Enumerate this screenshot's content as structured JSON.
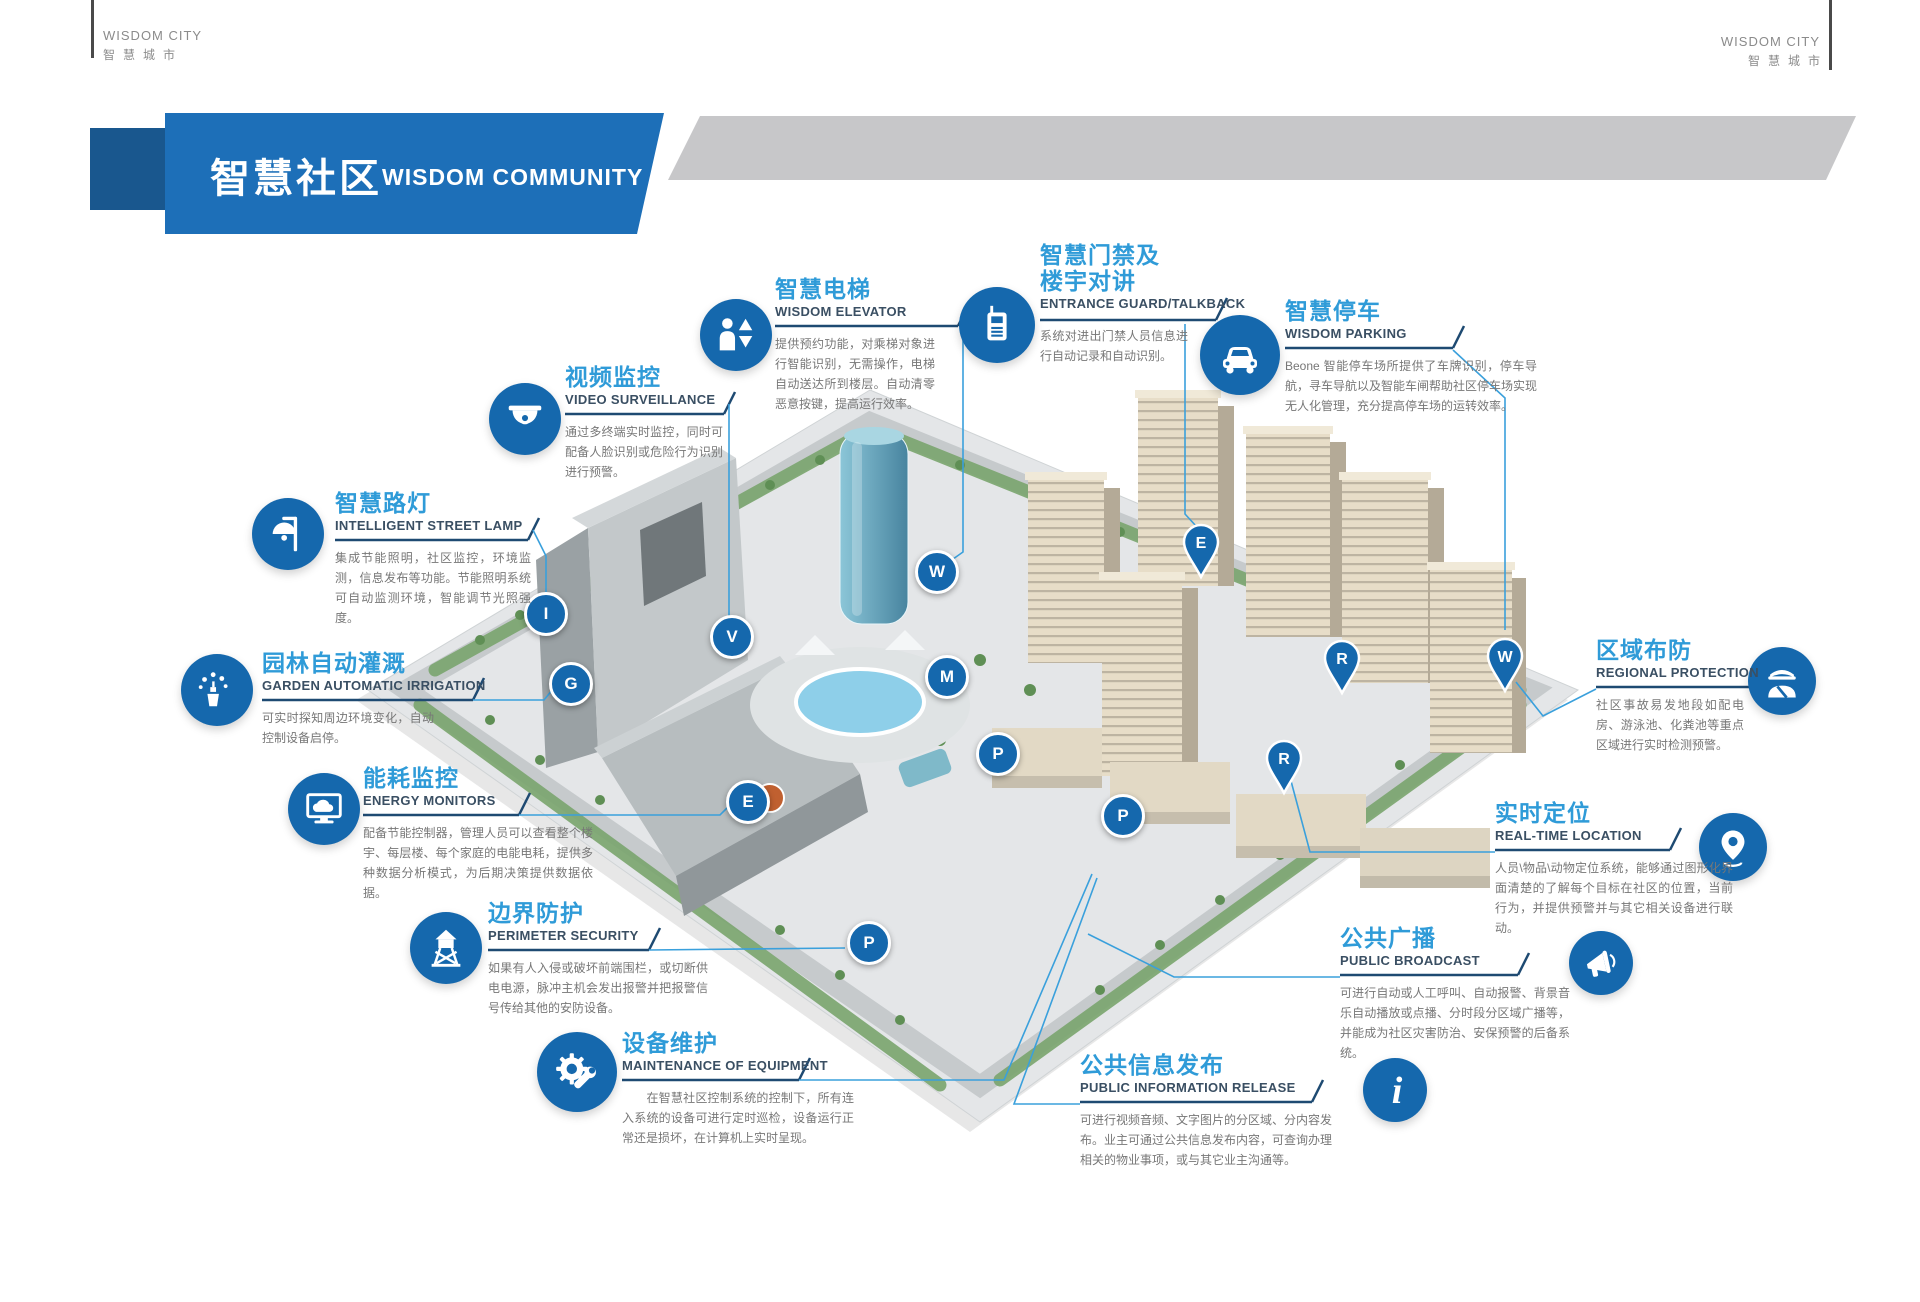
{
  "brand": {
    "en": "WISDOM CITY",
    "cn": "智慧城市"
  },
  "banner": {
    "title_cn": "智慧社区",
    "title_en": "WISDOM COMMUNITY"
  },
  "colors": {
    "banner_blue": "#1d6fb8",
    "banner_dark_blue": "#19578e",
    "gray_band": "#c7c7c9",
    "icon_circle_blue": "#1568ad",
    "title_blue": "#2f9bd8",
    "subtitle_navy": "#3a4f63",
    "underline_navy": "#1e4a72",
    "connector_blue": "#3aa0dc",
    "body_gray": "#777777"
  },
  "callouts": [
    {
      "id": "wisdom-elevator",
      "title_cn": "智慧电梯",
      "title_en": "WISDOM ELEVATOR",
      "icon": "elevator-icon",
      "body": "提供预约功能，对乘梯对象进行智能识别，无需操作，电梯自动送达所到楼层。自动清零恶意按键，提高运行效率。"
    },
    {
      "id": "video-surveillance",
      "title_cn": "视频监控",
      "title_en": "VIDEO SURVEILLANCE",
      "icon": "dome-camera-icon",
      "body": "通过多终端实时监控，同时可配备人脸识别或危险行为识别进行预警。"
    },
    {
      "id": "street-lamp",
      "title_cn": "智慧路灯",
      "title_en": "INTELLIGENT STREET LAMP",
      "icon": "street-lamp-icon",
      "body": "集成节能照明，社区监控，环境监测，信息发布等功能。节能照明系统可自动监测环境，智能调节光照强度。"
    },
    {
      "id": "garden-irrigation",
      "title_cn": "园林自动灌溉",
      "title_en": "GARDEN AUTOMATIC IRRIGATION",
      "icon": "sprinkler-icon",
      "body": "可实时探知周边环境变化，自动控制设备启停。"
    },
    {
      "id": "energy-monitors",
      "title_cn": "能耗监控",
      "title_en": "ENERGY MONITORS",
      "icon": "monitor-cloud-icon",
      "body": "配备节能控制器，管理人员可以查看整个楼宇、每层楼、每个家庭的电能电耗，提供多种数据分析模式，为后期决策提供数据依据。"
    },
    {
      "id": "perimeter-security",
      "title_cn": "边界防护",
      "title_en": "PERIMETER SECURITY",
      "icon": "watchtower-icon",
      "body": "如果有人入侵或破坏前端围栏，或切断供电电源，脉冲主机会发出报警并把报警信号传给其他的安防设备。"
    },
    {
      "id": "equipment-maintenance",
      "title_cn": "设备维护",
      "title_en": "MAINTENANCE OF EQUIPMENT",
      "icon": "gear-wrench-icon",
      "body": "　　在智慧社区控制系统的控制下，所有连入系统的设备可进行定时巡检，设备运行正常还是损坏，在计算机上实时呈现。"
    },
    {
      "id": "entrance-guard",
      "title_cn": "智慧门禁及\n楼宇对讲",
      "title_en": "ENTRANCE GUARD/TALKBACK",
      "icon": "intercom-icon",
      "body": "系统对进出门禁人员信息进行自动记录和自动识别。"
    },
    {
      "id": "wisdom-parking",
      "title_cn": "智慧停车",
      "title_en": "WISDOM PARKING",
      "icon": "car-icon",
      "body": "Beone 智能停车场所提供了车牌识别，停车导航，寻车导航以及智能车闸帮助社区停车场实现无人化管理，充分提高停车场的运转效率。"
    },
    {
      "id": "regional-protection",
      "title_cn": "区域布防",
      "title_en": "REGIONAL PROTECTION",
      "icon": "guard-icon",
      "body": "社区事故易发地段如配电房、游泳池、化粪池等重点区域进行实时检测预警。"
    },
    {
      "id": "realtime-location",
      "title_cn": "实时定位",
      "title_en": "REAL-TIME LOCATION",
      "icon": "location-pin-icon",
      "body": "人员\\物品\\动物定位系统，能够通过图形化界面清楚的了解每个目标在社区的位置，当前行为，并提供预警并与其它相关设备进行联动。"
    },
    {
      "id": "public-broadcast",
      "title_cn": "公共广播",
      "title_en": "PUBLIC BROADCAST",
      "icon": "megaphone-icon",
      "body": "可进行自动或人工呼叫、自动报警、背景音乐自动播放或点播、分时段分区域广播等，并能成为社区灾害防治、安保预警的后备系统。"
    },
    {
      "id": "public-information",
      "title_cn": "公共信息发布",
      "title_en": "PUBLIC INFORMATION RELEASE",
      "icon": "info-icon",
      "body": "可进行视频音频、文字图片的分区域、分内容发布。业主可通过公共信息发布内容，可查询办理相关的物业事项，或与其它业主沟通等。"
    }
  ],
  "markers": [
    {
      "letter": "I",
      "kind": "circle"
    },
    {
      "letter": "G",
      "kind": "circle"
    },
    {
      "letter": "V",
      "kind": "circle"
    },
    {
      "letter": "E",
      "kind": "circle"
    },
    {
      "letter": "W",
      "kind": "circle"
    },
    {
      "letter": "M",
      "kind": "circle"
    },
    {
      "letter": "P",
      "kind": "circle"
    },
    {
      "letter": "P",
      "kind": "circle"
    },
    {
      "letter": "P",
      "kind": "circle"
    },
    {
      "letter": "E",
      "kind": "pin"
    },
    {
      "letter": "R",
      "kind": "pin"
    },
    {
      "letter": "R",
      "kind": "pin"
    },
    {
      "letter": "W",
      "kind": "pin"
    }
  ]
}
